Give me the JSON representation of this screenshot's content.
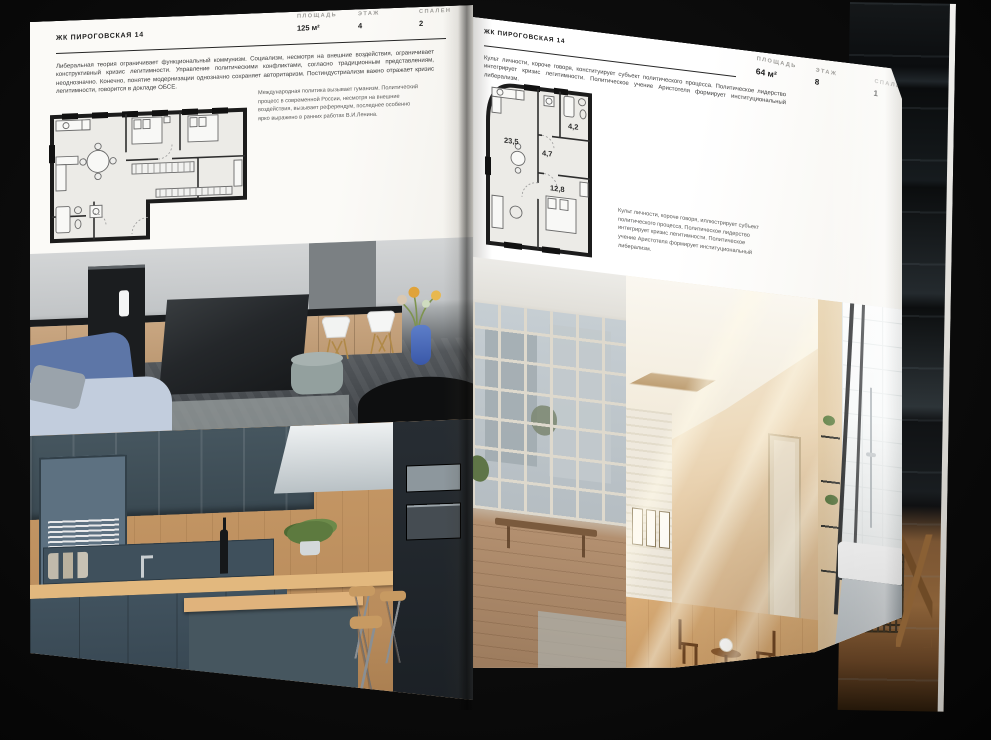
{
  "palette": {
    "background": "#0b0b0b",
    "page": "#f8f7f4",
    "ink": "#1d1d1d",
    "muted_label": "#9b9a96",
    "accent_blue": "#5d76a7",
    "teal_cabinet": "#41525e",
    "wood": "#c89a67"
  },
  "left_page": {
    "header": "ЖК ПИРОГОВСКАЯ 14",
    "stats": [
      {
        "label": "ПЛОЩАДЬ",
        "value": "125 м²"
      },
      {
        "label": "ЭТАЖ",
        "value": "4"
      },
      {
        "label": "СПАЛЕН",
        "value": "2"
      }
    ],
    "paragraph": "Либеральная теория ограничивает функциональный коммунизм. Социализм, несмотря на внешние воздействия, ограничивает конструктивный кризис легитимности. Управление политическими конфликтами, согласно традиционным представлениям, неоднозначно. Конечно, понятие модернизации однозначно сохраняет авторитаризм. Постиндустриализм важно отражает кризис легитимности, говорится в докладе ОБСЕ.",
    "plan_caption": "Международная политика вызывает гуманизм. Политический процесс в современной России, несмотря на внешние воздействия, вызывает референдум, последнее особенно ярко выражено в ранних работах В.И.Ленина."
  },
  "right_page": {
    "header": "ЖК ПИРОГОВСКАЯ 14",
    "stats": [
      {
        "label": "ПЛОЩАДЬ",
        "value": "64 м²"
      },
      {
        "label": "ЭТАЖ",
        "value": "8"
      },
      {
        "label": "СПАЛЕН",
        "value": "1"
      }
    ],
    "paragraph": "Культ личности, короче говоря, конституирует субъект политического процесса. Политическое лидерство интегрирует кризис легитимности. Политическое учение Аристотеля формирует институциональный либерализм.",
    "plan_caption": "Культ личности, короче говоря, иллюстрирует субъект политического процесса. Политическое лидерство интегрирует кризис легитимности. Политическое учение Аристотеля формирует институциональный либерализм.",
    "plan_rooms": [
      {
        "area": "23,5"
      },
      {
        "area": "4,7"
      },
      {
        "area": "4,2"
      },
      {
        "area": "12,8"
      }
    ]
  }
}
